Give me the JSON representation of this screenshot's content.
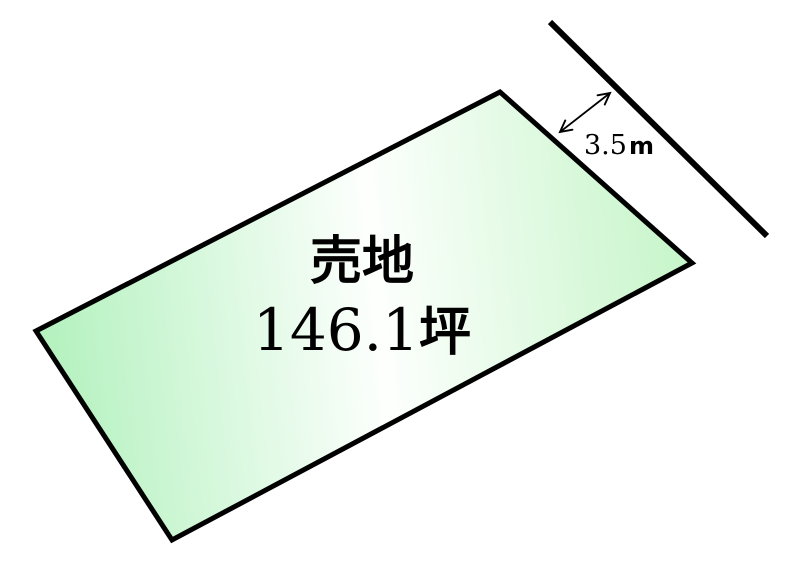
{
  "diagram": {
    "background_color": "#ffffff",
    "line_color": "#000000",
    "plot": {
      "label": "売地",
      "area_value": "146.1",
      "area_unit": "坪",
      "fill_gradient": {
        "start": "#b2f1bd",
        "middle": "#fdfffd",
        "end": "#c6f5c9"
      }
    },
    "dimension": {
      "value": "3.5",
      "unit": "m"
    }
  }
}
